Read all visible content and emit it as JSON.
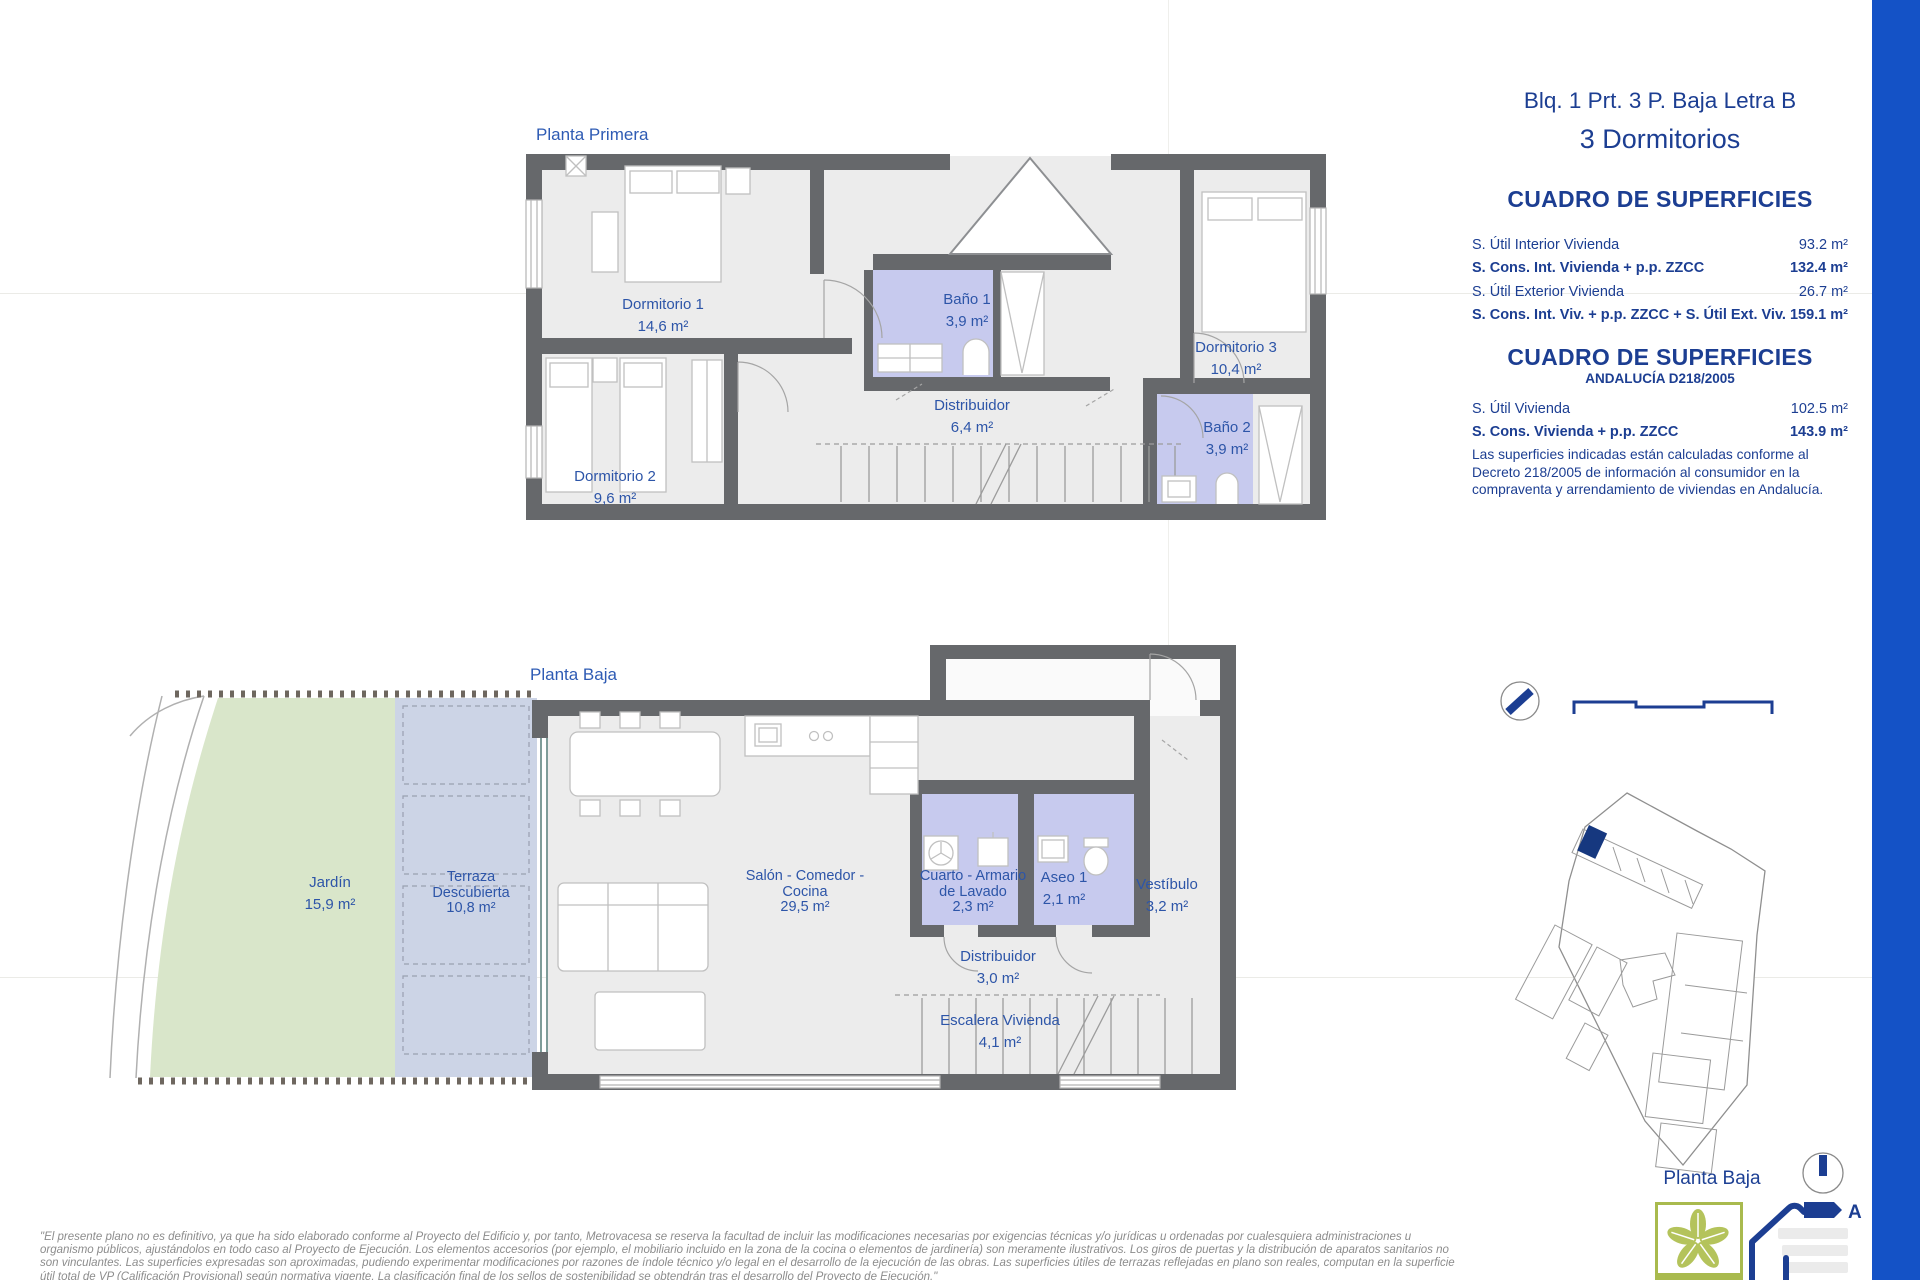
{
  "header": {
    "unit_title": "Blq. 1 Prt. 3 P. Baja Letra B",
    "unit_subtitle": "3 Dormitorios"
  },
  "surfaces_table_1": {
    "title": "CUADRO DE SUPERFICIES",
    "rows": [
      {
        "label": "S. Útil Interior Vivienda",
        "value": "93.2 m²"
      },
      {
        "label": "S. Cons. Int. Vivienda + p.p. ZZCC",
        "value": "132.4 m²"
      },
      {
        "label": "S. Útil Exterior Vivienda",
        "value": "26.7 m²"
      },
      {
        "label": "S. Cons. Int. Viv. + p.p. ZZCC + S. Útil Ext. Viv.",
        "value": "159.1 m²"
      }
    ]
  },
  "surfaces_table_2": {
    "title": "CUADRO DE SUPERFICIES",
    "subtitle": "ANDALUCÍA D218/2005",
    "rows": [
      {
        "label": "S. Útil Vivienda",
        "value": "102.5 m²"
      },
      {
        "label": "S. Cons. Vivienda + p.p. ZZCC",
        "value": "143.9 m²"
      }
    ],
    "note": "Las superficies indicadas están calculadas conforme al Decreto 218/2005 de información al consumidor en la compraventa y arrendamiento de viviendas en Andalucía."
  },
  "plans": {
    "primera": {
      "title": "Planta Primera",
      "rooms": [
        {
          "id": "dormitorio-1",
          "lines": [
            "Dormitorio 1",
            "14,6 m²"
          ]
        },
        {
          "id": "dormitorio-2",
          "lines": [
            "Dormitorio 2",
            "9,6 m²"
          ]
        },
        {
          "id": "bano-1",
          "lines": [
            "Baño 1",
            "3,9 m²"
          ]
        },
        {
          "id": "distribuidor",
          "lines": [
            "Distribuidor",
            "6,4 m²"
          ]
        },
        {
          "id": "dormitorio-3",
          "lines": [
            "Dormitorio 3",
            "10,4 m²"
          ]
        },
        {
          "id": "bano-2",
          "lines": [
            "Baño 2",
            "3,9 m²"
          ]
        }
      ]
    },
    "baja": {
      "title": "Planta Baja",
      "rooms": [
        {
          "id": "jardin",
          "lines": [
            "Jardín",
            "15,9 m²"
          ]
        },
        {
          "id": "terraza-descubierta",
          "lines": [
            "Terraza",
            "Descubierta",
            "10,8 m²"
          ]
        },
        {
          "id": "salon-comedor-cocina",
          "lines": [
            "Salón - Comedor -",
            "Cocina",
            "29,5 m²"
          ]
        },
        {
          "id": "cuarto-armario-lavado",
          "lines": [
            "Cuarto - Armario",
            "de Lavado",
            "2,3 m²"
          ]
        },
        {
          "id": "aseo-1",
          "lines": [
            "Aseo 1",
            "2,1 m²"
          ]
        },
        {
          "id": "vestibulo",
          "lines": [
            "Vestíbulo",
            "3,2 m²"
          ]
        },
        {
          "id": "distribuidor-baja",
          "lines": [
            "Distribuidor",
            "3,0 m²"
          ]
        },
        {
          "id": "escalera-vivienda",
          "lines": [
            "Escalera Vivienda",
            "4,1 m²"
          ]
        }
      ]
    }
  },
  "keyplan": {
    "label": "Planta Baja"
  },
  "logos": {
    "verde_label": "VERDE",
    "energy_rating": "A"
  },
  "disclaimer_lines": [
    "\"El presente plano no es definitivo, ya que ha sido elaborado conforme al Proyecto del Edificio y, por tanto, Metrovacesa se reserva la facultad de incluir las modificaciones necesarias por exigencias técnicas y/o jurídicas u ordenadas por cualesquiera administraciones u",
    "organismo públicos, ajustándolos en todo caso al Proyecto de Ejecución. Los elementos accesorios (por ejemplo, el mobiliario incluido en la zona de la cocina o elementos de jardinería) son meramente ilustrativos. Los giros de puertas y la distribución de aparatos sanitarios no",
    "son vinculantes. Las superficies expresadas son aproximadas, pudiendo experimentar modificaciones por razones de índole técnico y/o legal en el desarrollo de la ejecución de las obras. Las superficies útiles de terrazas reflejadas en plano son reales, computan en la superficie",
    "útil total de VP (Calificación Provisional) según normativa vigente. La clasificación final de los sellos de sostenibilidad se obtendrán tras el desarrollo del Proyecto de Ejecución.\""
  ],
  "colors": {
    "wall": "#66686b",
    "floor": "#ececec",
    "bath_fill": "#c7caee",
    "garden_fill": "#d9e6ca",
    "terrace_fill": "#ccd4e6",
    "navy_text": "#1c3e92",
    "plan_label": "#2d55a8",
    "blue_band": "#1452c6",
    "verde_green": "#a9ba4e"
  }
}
